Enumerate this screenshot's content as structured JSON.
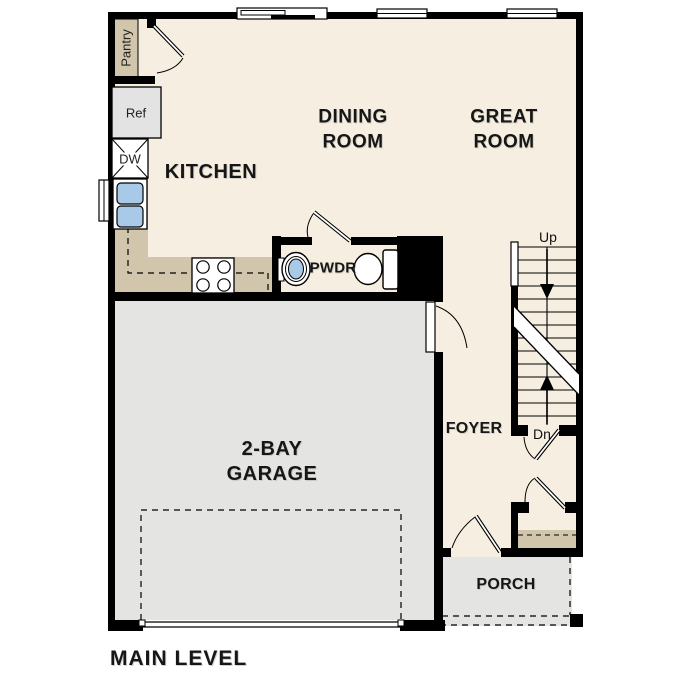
{
  "title": "MAIN LEVEL",
  "rooms": {
    "kitchen": "KITCHEN",
    "dining_line1": "DINING",
    "dining_line2": "ROOM",
    "great_line1": "GREAT",
    "great_line2": "ROOM",
    "pwdr": "PWDR",
    "foyer": "FOYER",
    "garage_line1": "2-BAY",
    "garage_line2": "GARAGE",
    "porch": "PORCH"
  },
  "fixtures": {
    "pantry": "Pantry",
    "refrigerator": "Ref",
    "dishwasher": "DW"
  },
  "stairs": {
    "up": "Up",
    "down": "Dn"
  },
  "colors": {
    "floor": "#f6efe1",
    "counter": "#d1c5ab",
    "concrete": "#e4e4e3",
    "appliance": "#e3e3e3",
    "fixture_blue": "#a9c9e9",
    "wall": "#000000",
    "text": "#161616"
  }
}
